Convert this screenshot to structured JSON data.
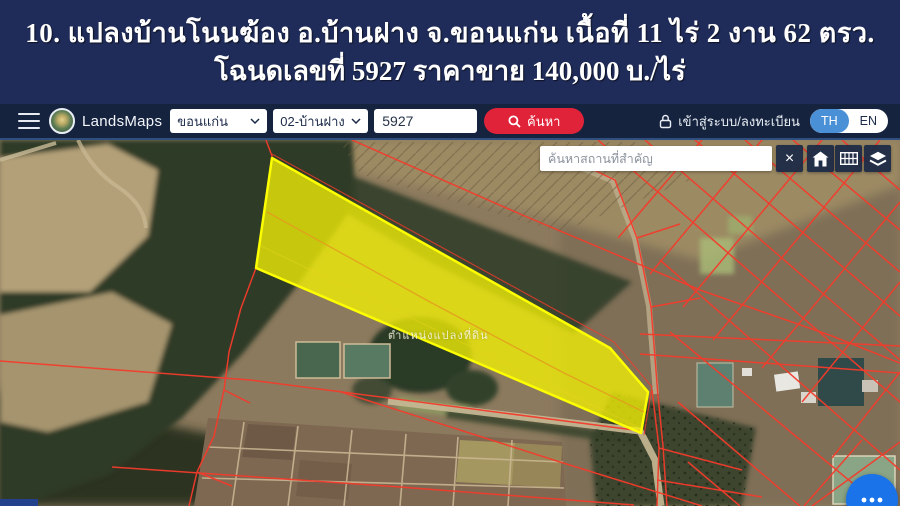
{
  "banner": {
    "line1": "10. แปลงบ้านโนนฆ้อง อ.บ้านฝาง จ.ขอนแก่น  เนื้อที่ 11 ไร่ 2 งาน 62 ตรว.",
    "line2": "โฉนดเลขที่ 5927  ราคาขาย 140,000 บ./ไร่"
  },
  "navbar": {
    "brand": "LandsMaps",
    "province": "ขอนแก่น",
    "district": "02-บ้านฝาง",
    "parcel_no": "5927",
    "search_label": "ค้นหา",
    "login_label": "เข้าสู่ระบบ/ลงทะเบียน",
    "lang_th": "TH",
    "lang_en": "EN"
  },
  "map": {
    "search_placeholder": "ค้นหาสถานที่สำคัญ",
    "close_label": "×",
    "parcel_label": "ตำแหน่งแปลงที่ดิน",
    "icons": {
      "menu": "hamburger-icon",
      "logo": "landsmaps-seal",
      "dropdown": "chevron-down-icon",
      "search": "magnifier-icon",
      "login": "lock-icon",
      "close": "close-icon",
      "home": "home-icon",
      "grid": "grid-icon",
      "layers": "layers-icon",
      "fab": "more-options-icon"
    }
  },
  "colors": {
    "banner_navy": "#1f2b58",
    "bar_navy": "#15233e",
    "accent_red": "#e02339",
    "lang_active_blue": "#4a90d6",
    "fab_blue": "#1a73e8",
    "parcel_yellow": "#f2ef06",
    "cadastral_red": "#f43b2c"
  }
}
